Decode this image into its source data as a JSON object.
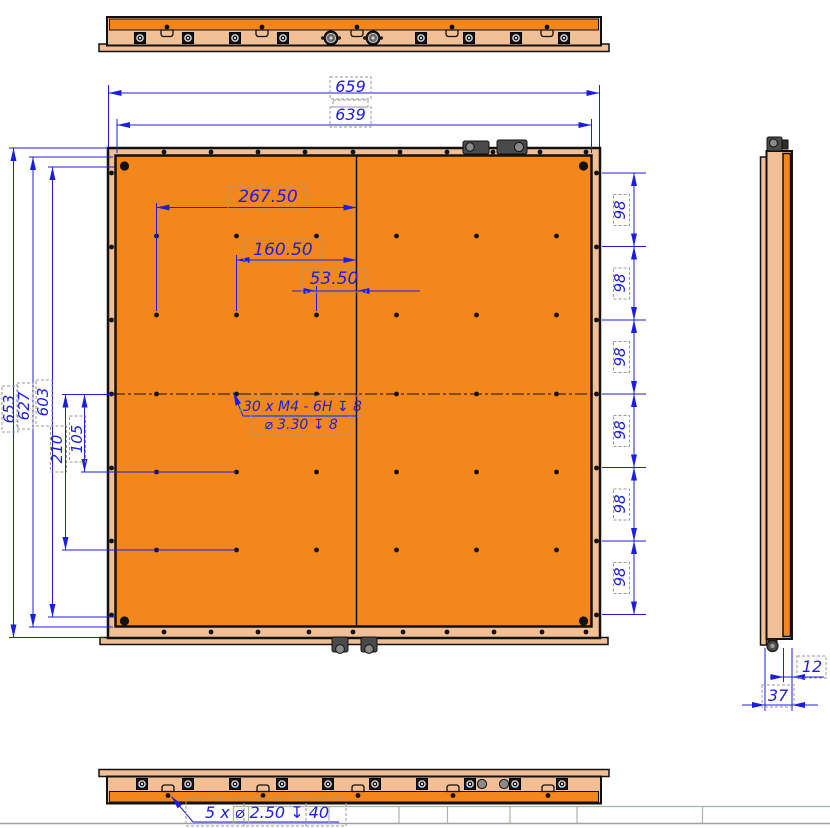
{
  "drawing": {
    "type": "cad-multiview-drawing",
    "part_color": "#F4871C",
    "frame_color": "#F2BE93",
    "dim_color": "#1d1de0",
    "views": {
      "top_view": "top view strip",
      "front_view": "front view panel",
      "side_view": "right side profile",
      "bottom_view": "bottom view strip"
    },
    "dims": {
      "overall_width": "659",
      "panel_width": "639",
      "overall_height": "653",
      "panel_height": "627",
      "mount_span": "603",
      "hole_x_outer": "267.50",
      "hole_x_mid": "160.50",
      "hole_x_inner": "53.50",
      "hole_y_outer": "210",
      "hole_y_inner": "105",
      "edge_pitch": [
        "98",
        "98",
        "98",
        "98",
        "98",
        "98"
      ],
      "side_panel": "12",
      "side_total": "37"
    },
    "callouts": {
      "thread_1": "30 x  M4 - 6H ↧ 8",
      "thread_2": "⌀ 3.30 ↧ 8",
      "bottom_holes": "5 x ⌀ 2.50 ↧ 40"
    }
  }
}
